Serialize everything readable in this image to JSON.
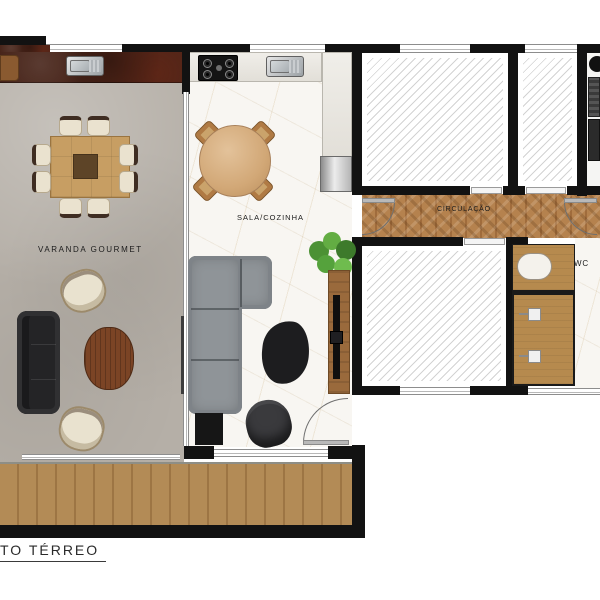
{
  "title": "TO TÉRREO",
  "labels": {
    "varanda": "VARANDA  GOURMET",
    "sala": "SALA/COZINHA",
    "circulacao": "CIRCULAÇÃO",
    "wc": "WC"
  },
  "colors": {
    "wall": "#121212",
    "concrete_floor": "#b5afa7",
    "marble_floor": "#f8f6f2",
    "deck_wood": "#b38b56",
    "herringbone_wood": "#b5824e",
    "cabinet_wood": "#b68a4e",
    "granite_counter": "#472419",
    "sofa_gray": "#8f9498",
    "sofa_black": "#242426",
    "armchair_cream": "#e9e2cf",
    "table_wood": "#c79e63",
    "coffee_table_wood": "#7b4425",
    "plant_green": "#55a23c",
    "hatch_line": "#d3d3d3"
  }
}
